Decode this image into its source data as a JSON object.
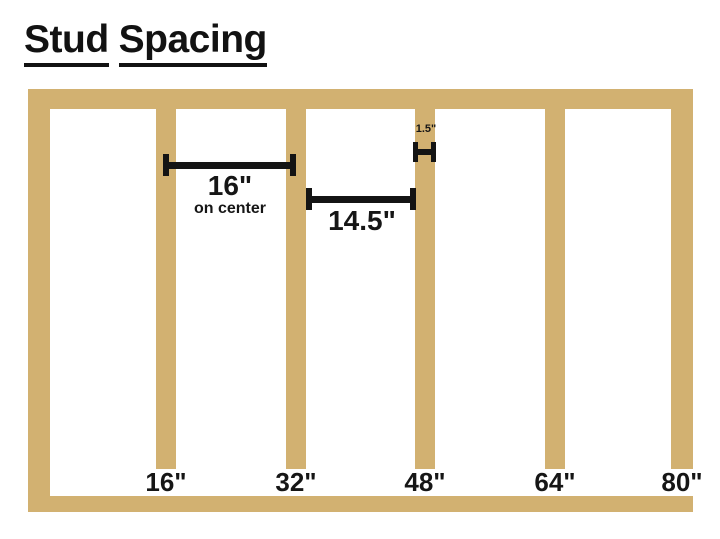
{
  "title": {
    "word1": "Stud",
    "word2": "Spacing"
  },
  "dimensions": {
    "on_center": {
      "value": "16\"",
      "caption": "on center"
    },
    "stud_gap": {
      "value": "14.5\""
    },
    "stud_width": {
      "value": "1.5\""
    }
  },
  "position_labels": [
    "16\"",
    "32\"",
    "48\"",
    "64\"",
    "80\""
  ],
  "frame": {
    "stud_count": 6,
    "plate_count": 2
  },
  "colors": {
    "wood": "#D2B171",
    "line": "#141414",
    "text": "#161616",
    "background": "#FFFFFF"
  }
}
